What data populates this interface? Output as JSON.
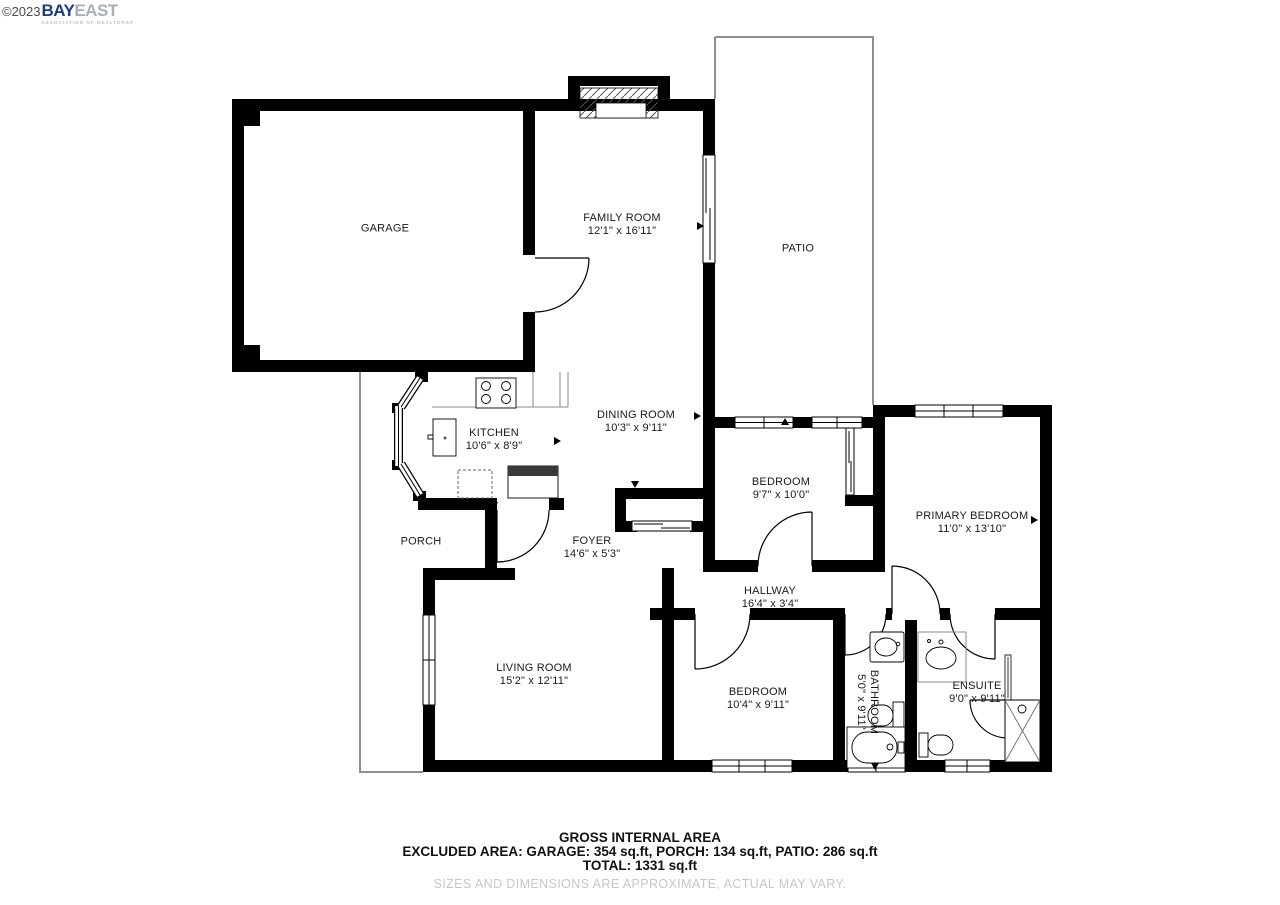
{
  "watermark": {
    "year": "©2023",
    "brand_bay": "BAY",
    "brand_east": "EAST",
    "subtitle": "ASSOCIATION OF REALTORS®"
  },
  "rooms": {
    "garage": {
      "name": "GARAGE"
    },
    "family_room": {
      "name": "FAMILY ROOM",
      "dims": "12'1\" x 16'11\""
    },
    "patio": {
      "name": "PATIO"
    },
    "kitchen": {
      "name": "KITCHEN",
      "dims": "10'6\" x 8'9\""
    },
    "dining_room": {
      "name": "DINING ROOM",
      "dims": "10'3\" x 9'11\""
    },
    "bedroom_top": {
      "name": "BEDROOM",
      "dims": "9'7\" x 10'0\""
    },
    "primary_bedroom": {
      "name": "PRIMARY BEDROOM",
      "dims": "11'0\" x 13'10\""
    },
    "porch": {
      "name": "PORCH"
    },
    "foyer": {
      "name": "FOYER",
      "dims": "14'6\" x 5'3\""
    },
    "hallway": {
      "name": "HALLWAY",
      "dims": "16'4\" x 3'4\""
    },
    "living_room": {
      "name": "LIVING ROOM",
      "dims": "15'2\" x 12'11\""
    },
    "bedroom_bottom": {
      "name": "BEDROOM",
      "dims": "10'4\" x 9'11\""
    },
    "bathroom": {
      "name": "BATHROOM",
      "dims": "5'0\" x 9'11\""
    },
    "ensuite": {
      "name": "ENSUITE",
      "dims": "9'0\" x 9'11\""
    }
  },
  "footer": {
    "title": "GROSS INTERNAL AREA",
    "excluded": "EXCLUDED AREA: GARAGE: 354 sq.ft, PORCH: 134 sq.ft, PATIO: 286 sq.ft",
    "total": "TOTAL: 1331 sq.ft",
    "disclaimer": "SIZES AND DIMENSIONS ARE APPROXIMATE, ACTUAL MAY VARY."
  },
  "colors": {
    "wall": "#000000",
    "outline_thin": "#8f8f8f",
    "brand_navy": "#1c3e7c",
    "brand_gray": "#a8afb6",
    "disclaimer_gray": "#c6c6c6"
  }
}
